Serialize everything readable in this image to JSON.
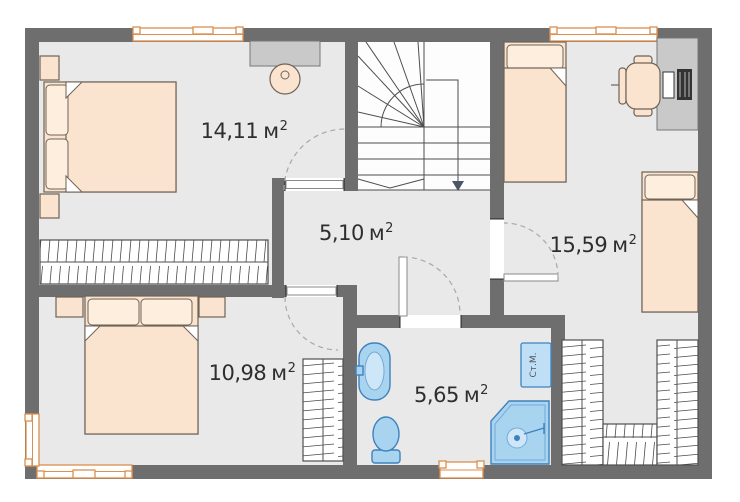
{
  "rooms": [
    {
      "name": "bedroom-main",
      "value": "14,11",
      "unit": "м",
      "sup": "2"
    },
    {
      "name": "hallway",
      "value": "5,10",
      "unit": "м",
      "sup": "2"
    },
    {
      "name": "kids-room",
      "value": "15,59",
      "unit": "м",
      "sup": "2"
    },
    {
      "name": "bedroom-second",
      "value": "10,98",
      "unit": "м",
      "sup": "2"
    },
    {
      "name": "bathroom",
      "value": "5,65",
      "unit": "м",
      "sup": "2"
    }
  ],
  "appliances": {
    "washing_machine": "Ст.М."
  },
  "colors": {
    "wall": "#6e6e6e",
    "floor": "#e9e9e9",
    "stair_floor": "#fdfdfd",
    "furniture_fill": "#fbe4cf",
    "furniture_stroke": "#6f6257",
    "sanitary_fill": "#a9d4f0",
    "sanitary_stroke": "#3e82bd",
    "desk_fill": "#c9c9c9",
    "window_frame": "#dd8f4d",
    "label_text": "#2e2e2e"
  }
}
